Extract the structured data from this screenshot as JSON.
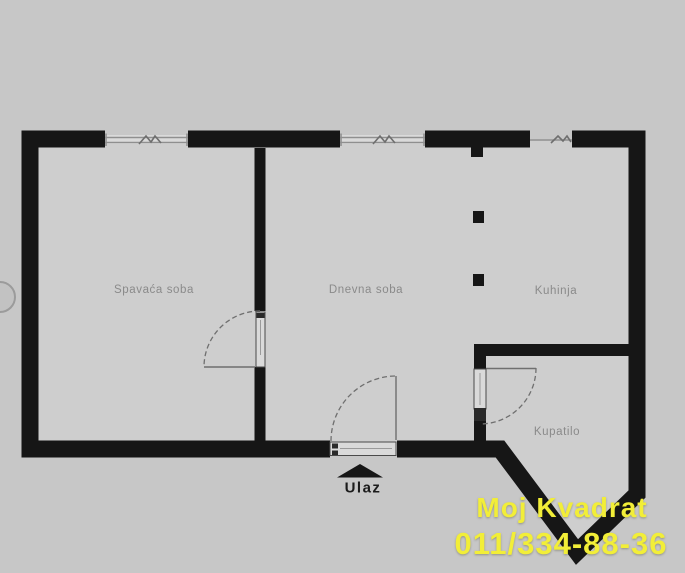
{
  "image": {
    "kind": "apartment-floor-plan",
    "width_px": 685,
    "height_px": 573
  },
  "floor_plan": {
    "rooms": [
      {
        "id": "bedroom",
        "label": "Spavaća soba"
      },
      {
        "id": "living-room",
        "label": "Dnevna soba"
      },
      {
        "id": "kitchen",
        "label": "Kuhinja"
      },
      {
        "id": "bathroom",
        "label": "Kupatilo"
      }
    ],
    "entrance": {
      "label": "Ulaz",
      "marker": "up-arrow-icon"
    },
    "features": {
      "windows": 3,
      "doors": 3,
      "columns": 2
    }
  },
  "watermark": {
    "line1": "Moj Kvadrat",
    "line2": "011/334-88-36"
  },
  "colors": {
    "background": "#c7c7c7",
    "floor": "#cecece",
    "wall": "#161616",
    "window_line": "#8f8f8f",
    "door_line": "#6f6f6f",
    "leaf_fill": "#dadada",
    "leaf_stroke": "#4a4a4a",
    "room_label": "#8a8a8a",
    "entrance_label": "#1b1b1b",
    "watermark": "#f2ee38"
  }
}
